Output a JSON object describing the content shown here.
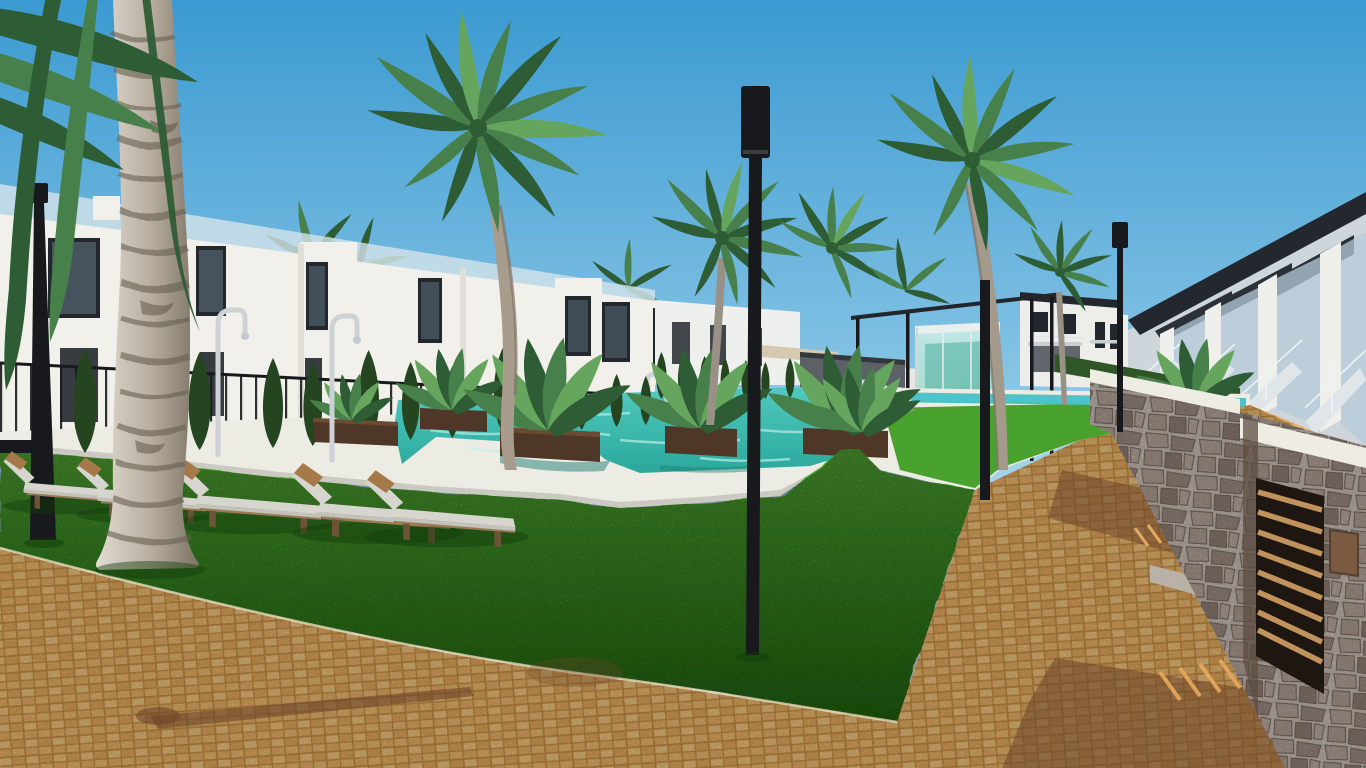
{
  "meta": {
    "title": "Residential complex 3D render",
    "description": "Architectural 3D rendering of a modern Mediterranean residential complex: white two-storey townhouses with rooftop glass balustrades on the left, a turquoise swimming pool with dark wooden planters and tropical plants in the centre, bright green lawns with grey sun loungers and brown cushions, tall palm trees and cypress trees, black lamp posts, a glass pavilion, and on the right a row of townhouses with staircases above a stone-clad wall with a slatted wooden gate beside an orange brick-paved walkway, all under a clear blue sky.",
    "width": 1366,
    "height": 768
  },
  "palette": {
    "sky_top": "#3b9ad1",
    "sky_mid": "#7fc0e3",
    "sky_low": "#c6e6f3",
    "sky_horizon": "#e2f2f8",
    "building_white": "#f2f0ea",
    "building_shade": "#ddddd5",
    "window_dark": "#23282e",
    "glass_rail": "#d4e4ea",
    "grass_far": "#57ab36",
    "grass_mid": "#3f9627",
    "grass_near": "#246a0f",
    "pool_deep": "#2aa89b",
    "pool_light": "#52cac0",
    "pool_ripple": "#bff2ea",
    "pool_arm": "#4cc3cf",
    "deck_white": "#ecebe4",
    "deck_shade": "#d9d8d0",
    "paving": "#e3aa5e",
    "paving_light": "#f2c57e",
    "paving_gap": "#c89045",
    "shadow_warm": "#6e4629",
    "stone": "#b3a195",
    "stone_mortar": "#d7cdc4",
    "coping_white": "#efece4",
    "wood_planter": "#4e3726",
    "wood_planter_dark": "#36251a",
    "wood_frame": "#9a7b56",
    "wood_gate": "#c0925c",
    "cushion": "#d6d6cf",
    "pillow": "#a5794a",
    "leaf_dark": "#2d5c35",
    "leaf_mid": "#47804a",
    "leaf_light": "#66a55e",
    "cypress": "#24451f",
    "trunk_light": "#e2dcd2",
    "trunk_mid": "#b6ac9e",
    "trunk_shade": "#7b7263",
    "trunk_ring": "#67604f",
    "metal_black": "#17191c",
    "chrome": "#ccd2d6",
    "roof_dark": "#23282e",
    "wall_gray": "#cfd6db",
    "towel_tan": "#c98a46",
    "awning_beige": "#d6c9b2",
    "pavilion_teal": "#8fd2c6"
  },
  "scene": {
    "objects": [
      {
        "name": "sky",
        "label": "clear blue sky"
      },
      {
        "name": "townhouses-left",
        "label": "white two-storey townhouses with rooftop glass balustrades"
      },
      {
        "name": "townhouses-right",
        "label": "townhouse row with exterior staircases over stone wall"
      },
      {
        "name": "swimming-pool",
        "label": "turquoise swimming pool with lap lane"
      },
      {
        "name": "pool-deck",
        "label": "white pool deck"
      },
      {
        "name": "lawn",
        "label": "bright green lawn"
      },
      {
        "name": "paved-path",
        "label": "orange brick paving",
        "count": 2
      },
      {
        "name": "stone-wall",
        "label": "stone-clad wall with wooden slat gate and plaque"
      },
      {
        "name": "glass-pavilion",
        "label": "glass pavilion"
      },
      {
        "name": "palm-tree",
        "label": "palm trees",
        "count": 8
      },
      {
        "name": "cypress-tree",
        "label": "cypress trees",
        "count": 20
      },
      {
        "name": "sun-lounger",
        "label": "sun loungers with cushions",
        "count": 9
      },
      {
        "name": "planter",
        "label": "dark wooden planters with tropical plants",
        "count": 6
      },
      {
        "name": "outdoor-shower",
        "label": "chrome outdoor showers",
        "count": 2
      },
      {
        "name": "lamp-post",
        "label": "black lamp posts",
        "count": 4
      }
    ]
  }
}
